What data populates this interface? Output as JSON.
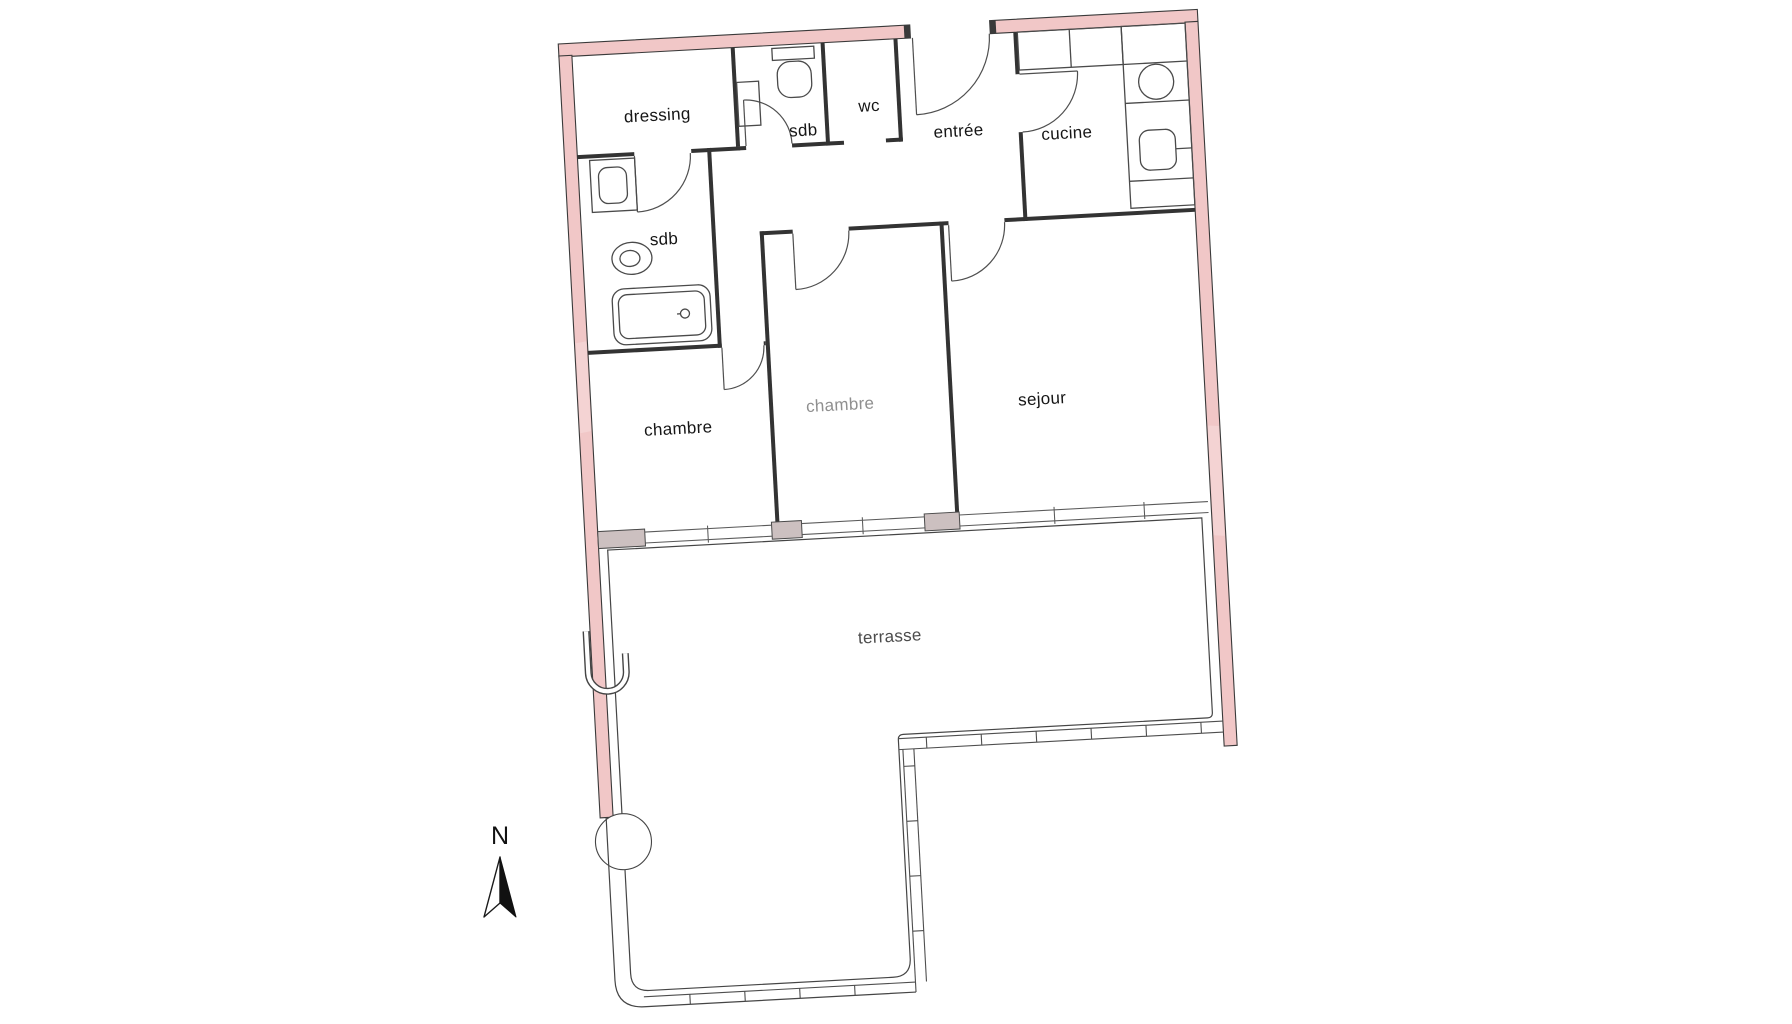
{
  "rooms": [
    {
      "id": "dressing",
      "label": "dressing"
    },
    {
      "id": "sdb_top",
      "label": "sdb"
    },
    {
      "id": "wc",
      "label": "wc"
    },
    {
      "id": "entree",
      "label": "entrée"
    },
    {
      "id": "cucine",
      "label": "cucine"
    },
    {
      "id": "sdb_main",
      "label": "sdb"
    },
    {
      "id": "chambre_left",
      "label": "chambre"
    },
    {
      "id": "chambre_middle",
      "label": "chambre"
    },
    {
      "id": "sejour",
      "label": "sejour"
    },
    {
      "id": "terrasse",
      "label": "terrasse"
    }
  ],
  "compass": {
    "north_label": "N"
  },
  "colors": {
    "wall_pink": "#f1c7c7",
    "wall_line": "#3a3a3a",
    "interior_wall": "#333333",
    "window_stub": "#ccc0c0",
    "hatch_line": "#757575",
    "label_dark": "#161616",
    "label_gray": "#8f8f8f",
    "label_terrasse": "#4c4c4c",
    "background": "#ffffff"
  }
}
